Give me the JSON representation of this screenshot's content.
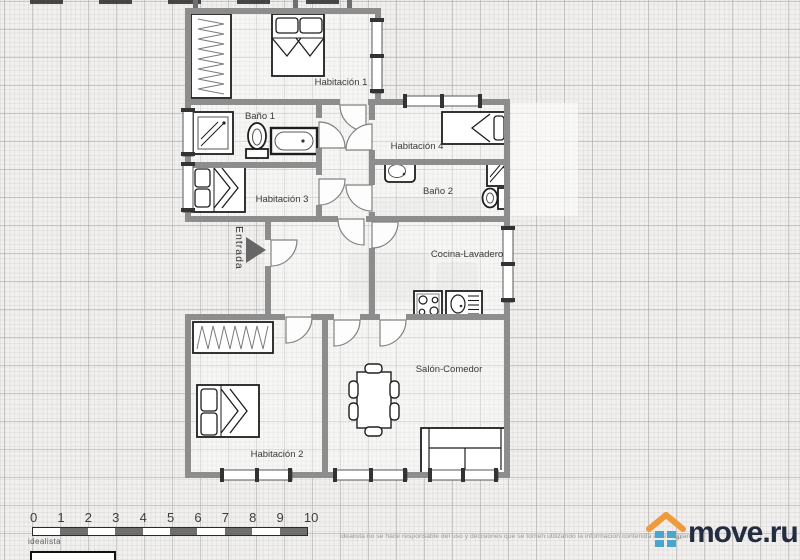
{
  "plan": {
    "rooms": {
      "habitacion1": "Habitación 1",
      "bano1": "Baño 1",
      "habitacion3": "Habitación 3",
      "habitacion4": "Habitación 4",
      "bano2": "Baño 2",
      "cocina": "Cocina-Lavadero",
      "salon": "Salón-Comedor",
      "habitacion2": "Habitación 2",
      "entrada": "Entrada"
    }
  },
  "scale_bar": {
    "ticks": [
      "0",
      "1",
      "2",
      "3",
      "4",
      "5",
      "6",
      "7",
      "8",
      "9",
      "10"
    ],
    "brand": "idealista"
  },
  "footer": {
    "disclaimer": "idealista no se hace responsable del uso y decisiones que se tomen utilizando la información contenida en esta plan",
    "disclaimer_tail": "qu",
    "logo_text": "move.ru"
  },
  "colors": {
    "wall": "#8d8d8d",
    "paper": "#f1f0ee",
    "logo_roof_orange": "#f09a3e",
    "logo_squares_blue": "#4aa6cf",
    "logo_text_navy": "#232c40"
  }
}
